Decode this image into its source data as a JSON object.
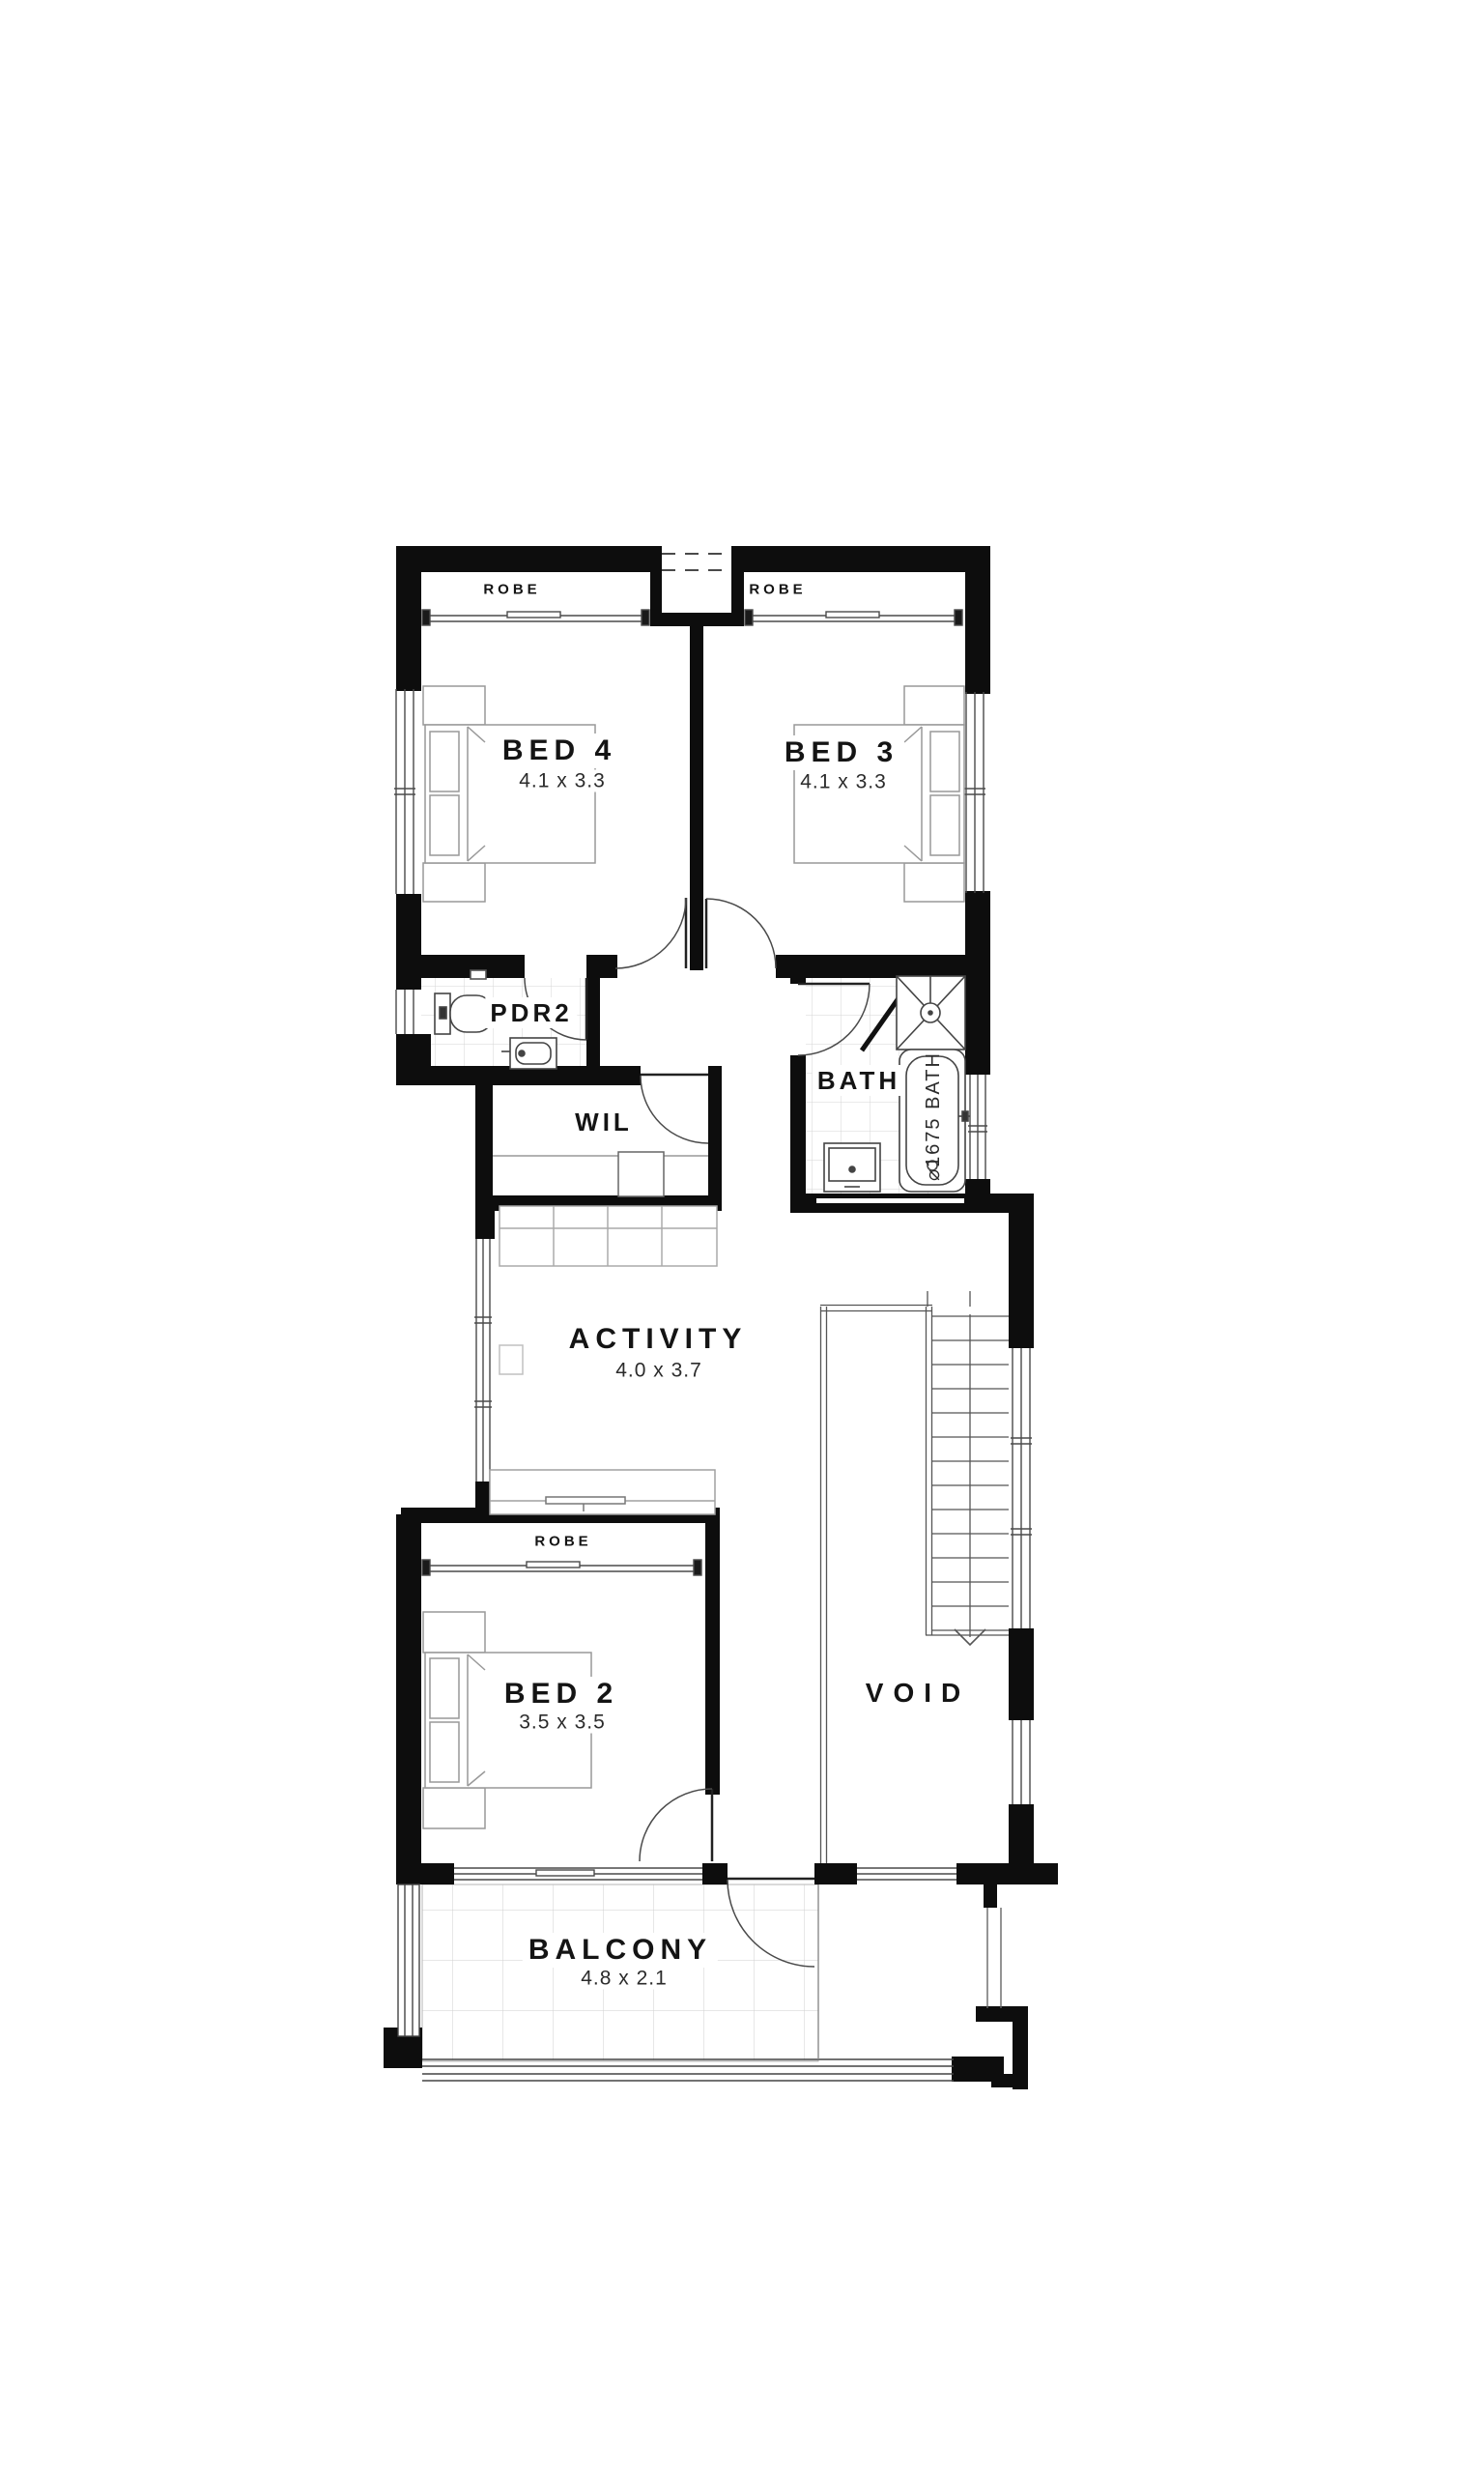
{
  "plan": {
    "rooms": {
      "bed4": {
        "label": "BED 4",
        "dims": "4.1 x 3.3"
      },
      "bed3": {
        "label": "BED 3",
        "dims": "4.1 x 3.3"
      },
      "bed2": {
        "label": "BED 2",
        "dims": "3.5 x 3.5"
      },
      "activity": {
        "label": "ACTIVITY",
        "dims": "4.0 x 3.7"
      },
      "balcony": {
        "label": "BALCONY",
        "dims": "4.8 x 2.1"
      },
      "pdr2": {
        "label": "PDR2"
      },
      "wil": {
        "label": "WIL"
      },
      "bath": {
        "label": "BATH"
      },
      "void": {
        "label": "VOID"
      }
    },
    "wardrobes": {
      "bed4_robe": "ROBE",
      "bed3_robe": "ROBE",
      "bed2_robe": "ROBE"
    },
    "fixtures": {
      "bathtub_label": "⌀1675 BATH"
    },
    "colors": {
      "wall": "#0d0d0d",
      "fixture_line": "#444444",
      "furniture_line": "#999999",
      "tile_line": "#d6d6d6",
      "text": "#141414"
    }
  }
}
